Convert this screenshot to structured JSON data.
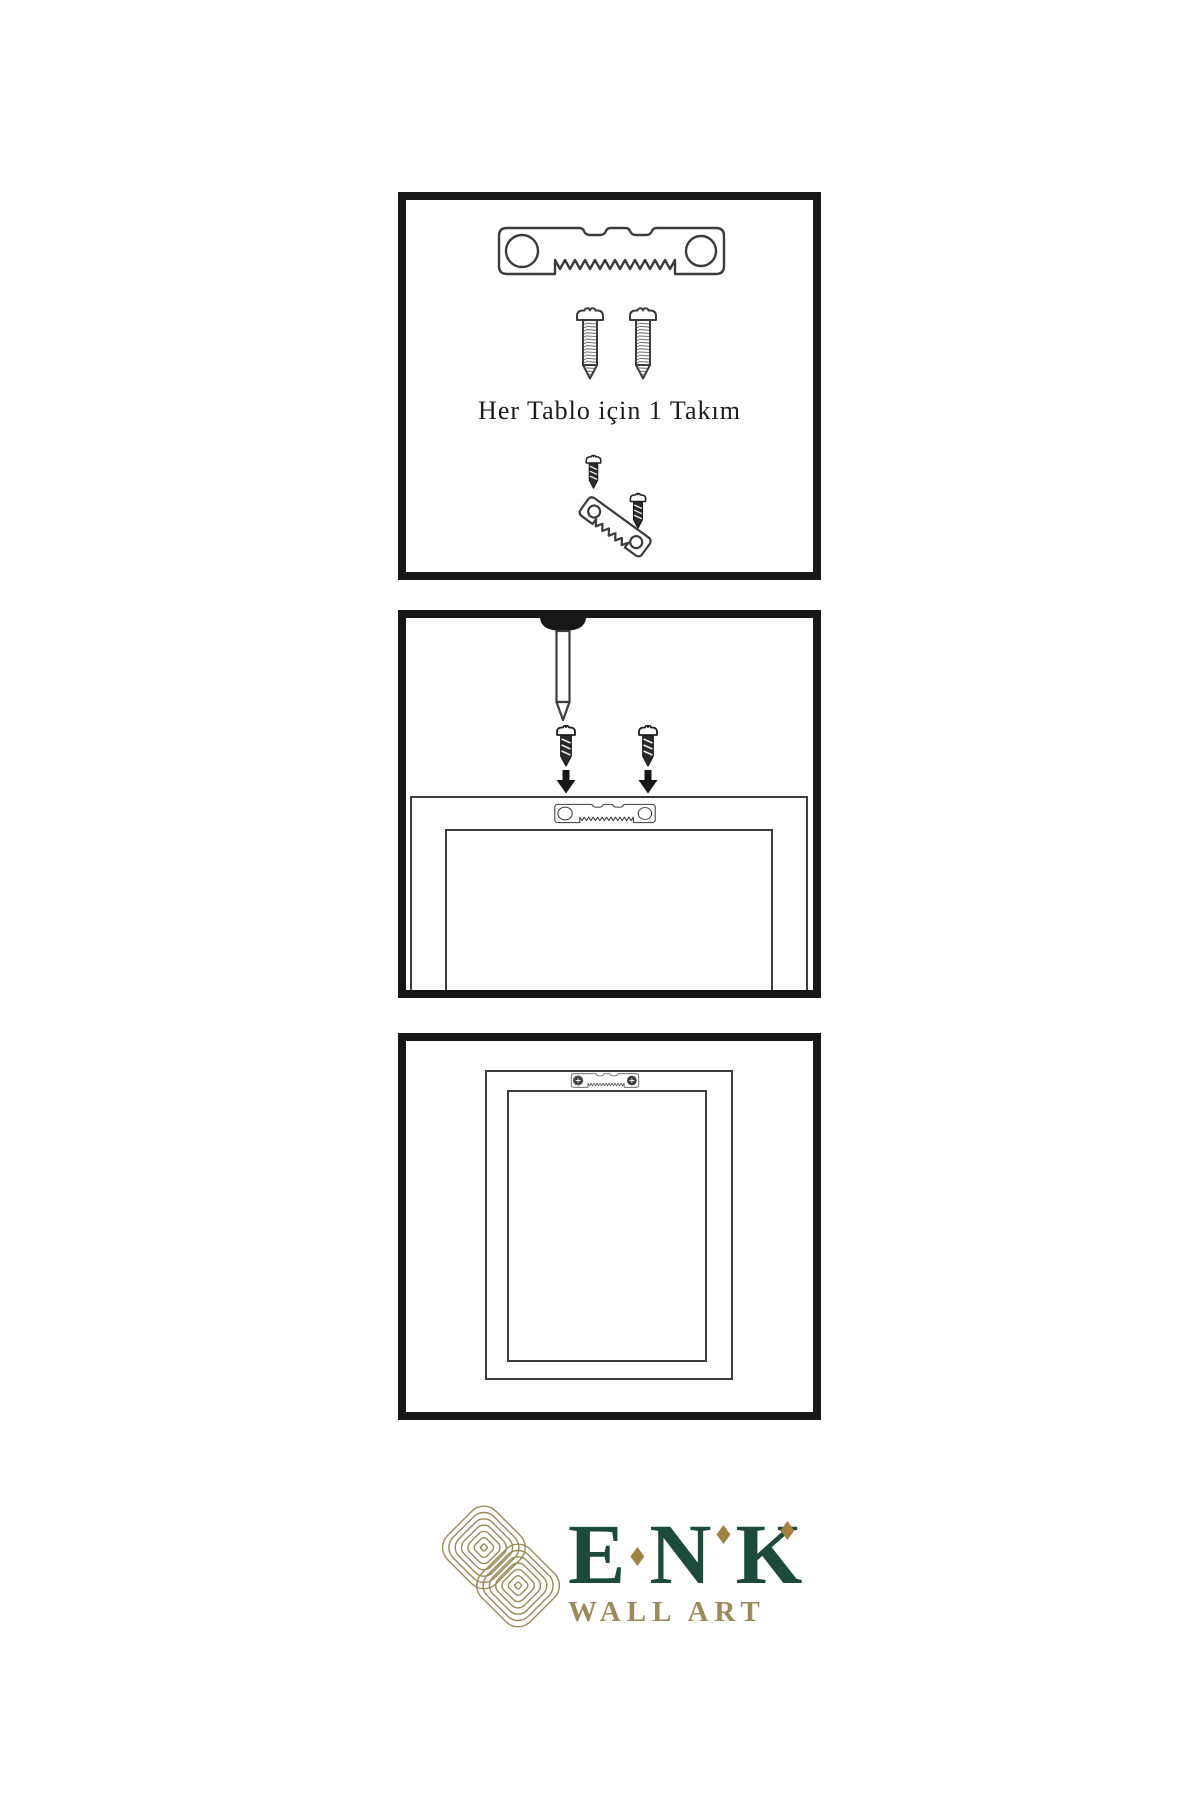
{
  "colors": {
    "background": "#ffffff",
    "ink": "#171717",
    "line": "#3c3c3c",
    "screw_dark": "#2b2b2b",
    "green": "#1d4b39",
    "gold": "#9c8a58",
    "diamond": "#a3813e",
    "text": "#1c1c1c"
  },
  "panels": [
    {
      "name": "hardware-kit",
      "caption": "Her Tablo için 1 Takım",
      "icons": [
        "sawtooth-hanger-icon",
        "screw-icon",
        "screw-icon",
        "mini-screw-icon",
        "tilted-sawtooth-hanger-icon",
        "mini-screw-icon"
      ]
    },
    {
      "name": "wall-mounting-step",
      "icons": [
        "nail-icon",
        "dark-screw-icon",
        "dark-screw-icon",
        "down-arrow-icon",
        "down-arrow-icon",
        "sawtooth-hanger-icon",
        "frame-back-outline"
      ]
    },
    {
      "name": "hung-frame",
      "icons": [
        "mounted-sawtooth-hanger-icon",
        "frame-back-outline"
      ]
    }
  ],
  "brand": {
    "name": "ENK",
    "letters": [
      "E",
      "N",
      "K"
    ],
    "subtitle": "WALL ART",
    "logo": "interlocking-knot-logo"
  }
}
